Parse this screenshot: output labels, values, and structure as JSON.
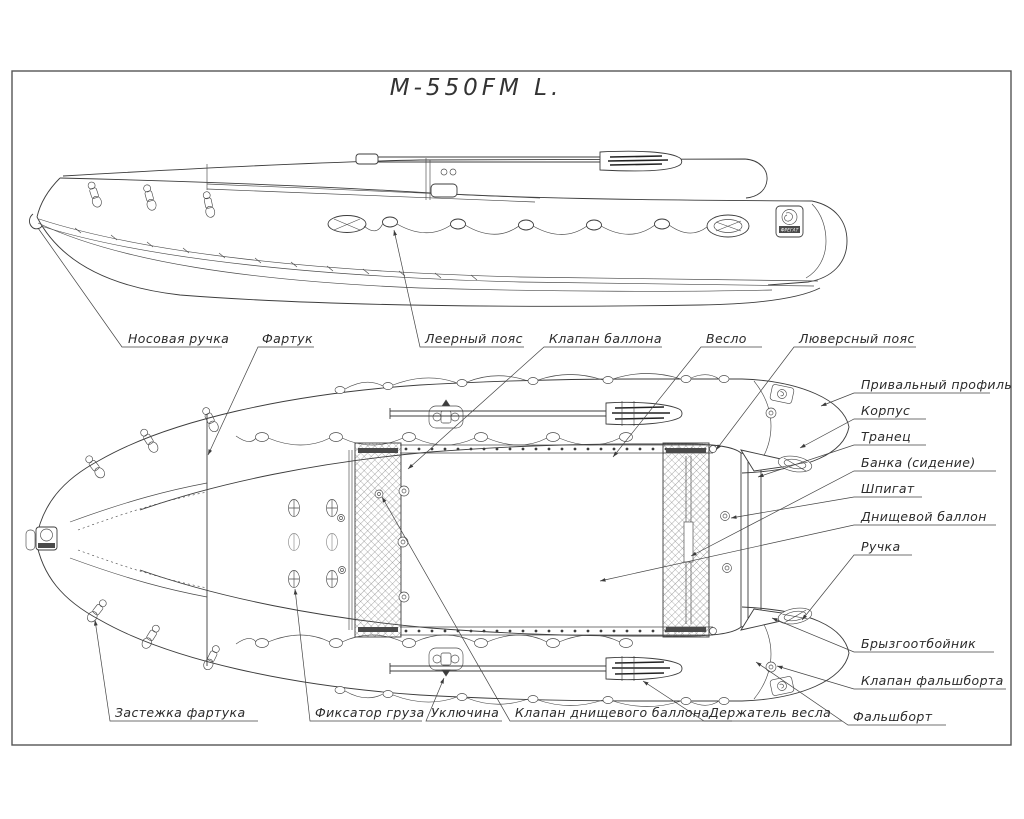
{
  "title": "М-550FM L.",
  "brand_logo_text": "ФРЕГАТ",
  "labels": {
    "nose_handle": "Носовая ручка",
    "apron": "Фартук",
    "leer_belt": "Леерный пояс",
    "tube_valve": "Клапан баллона",
    "oar": "Весло",
    "grommet_belt": "Люверсный пояс",
    "rub_profile": "Привальный профиль",
    "hull": "Корпус",
    "transom": "Транец",
    "seat": "Банка (сидение)",
    "drain": "Шпигат",
    "floor_tube": "Днищевой баллон",
    "handle": "Ручка",
    "spray_guard": "Брызгоотбойник",
    "bulwark_valve": "Клапан фальшборта",
    "bulwark": "Фальшборт",
    "apron_fastener": "Застежка фартука",
    "cargo_fixer": "Фиксатор груза",
    "rowlock": "Уключина",
    "floor_valve": "Клапан днищевого баллона",
    "oar_holder": "Держатель весла"
  }
}
